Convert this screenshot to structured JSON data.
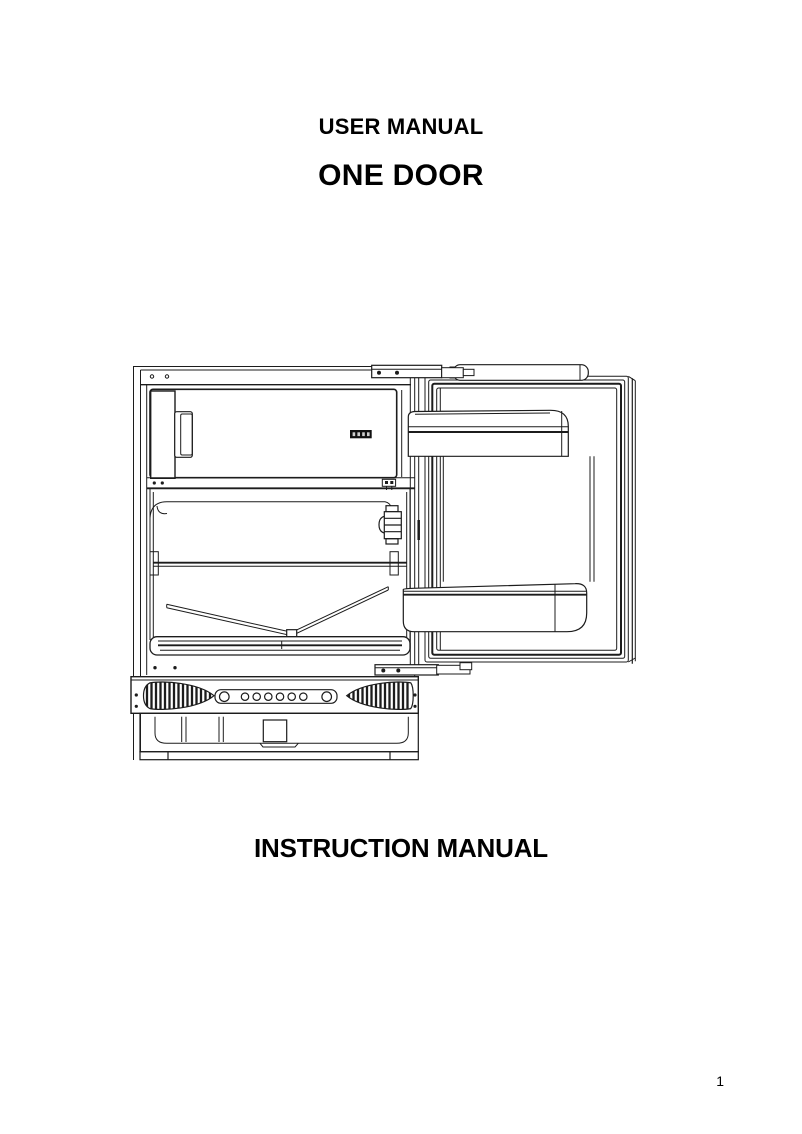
{
  "document": {
    "header_title": "USER MANUAL",
    "product_title": "ONE DOOR",
    "footer_title": "INSTRUCTION MANUAL",
    "page_number": "1"
  },
  "figure": {
    "alt": "Technical line drawing of a built-in one-door refrigerator shown with its door open",
    "ink": "#1c1c1c",
    "paper": "#ffffff",
    "display_fill": "#111111",
    "display_segments": 4,
    "vent_hole_count": 8,
    "parts": [
      "cabinet-frame",
      "top-hinge",
      "freezer-compartment",
      "freezer-door-handle",
      "control-panel-display",
      "compartment-divider",
      "main-compartment",
      "thermostat-housing",
      "glass-shelf",
      "crisper-cover",
      "door-sill",
      "bottom-hinge",
      "ventilation-grille",
      "vent-hole-strip",
      "plinth-drawer",
      "refrigerator-door",
      "door-top-trim",
      "door-upper-balcony",
      "door-lower-balcony"
    ]
  }
}
